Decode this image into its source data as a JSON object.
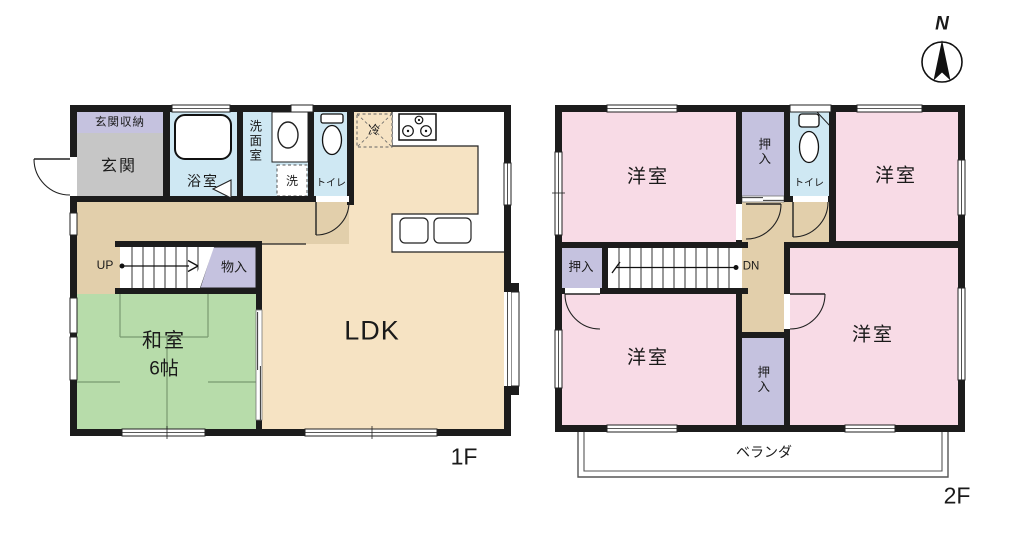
{
  "compass": {
    "north": "N"
  },
  "floor1": {
    "floor_label": "1F",
    "rooms": {
      "entrance_storage": "玄関収納",
      "entrance": "玄関",
      "bathroom": "浴室",
      "washroom": "洗面室",
      "laundry": "洗",
      "toilet": "トイレ",
      "fridge": "冷",
      "stairs_up": "UP",
      "storage": "物入",
      "japanese_room": "和室",
      "japanese_room_size": "6帖",
      "ldk": "LDK"
    }
  },
  "floor2": {
    "floor_label": "2F",
    "rooms": {
      "western_room_tl": "洋室",
      "western_room_tr": "洋室",
      "western_room_bl": "洋室",
      "western_room_br": "洋室",
      "closet_top": "押入",
      "closet_mid": "押入",
      "closet_bottom": "押入",
      "toilet": "トイレ",
      "stairs_down": "DN",
      "veranda": "ベランダ"
    }
  },
  "colors": {
    "wall": "#1c1c1c",
    "ldk_floor": "#f6e3c3",
    "hallway_floor": "#e2cfab",
    "tatami": "#b7dcaa",
    "tatami_line": "#6f8f66",
    "western_room": "#f8dbe6",
    "closet": "#c5c2df",
    "wet_area": "#cfe8f3",
    "entrance": "#c6c6c6"
  }
}
